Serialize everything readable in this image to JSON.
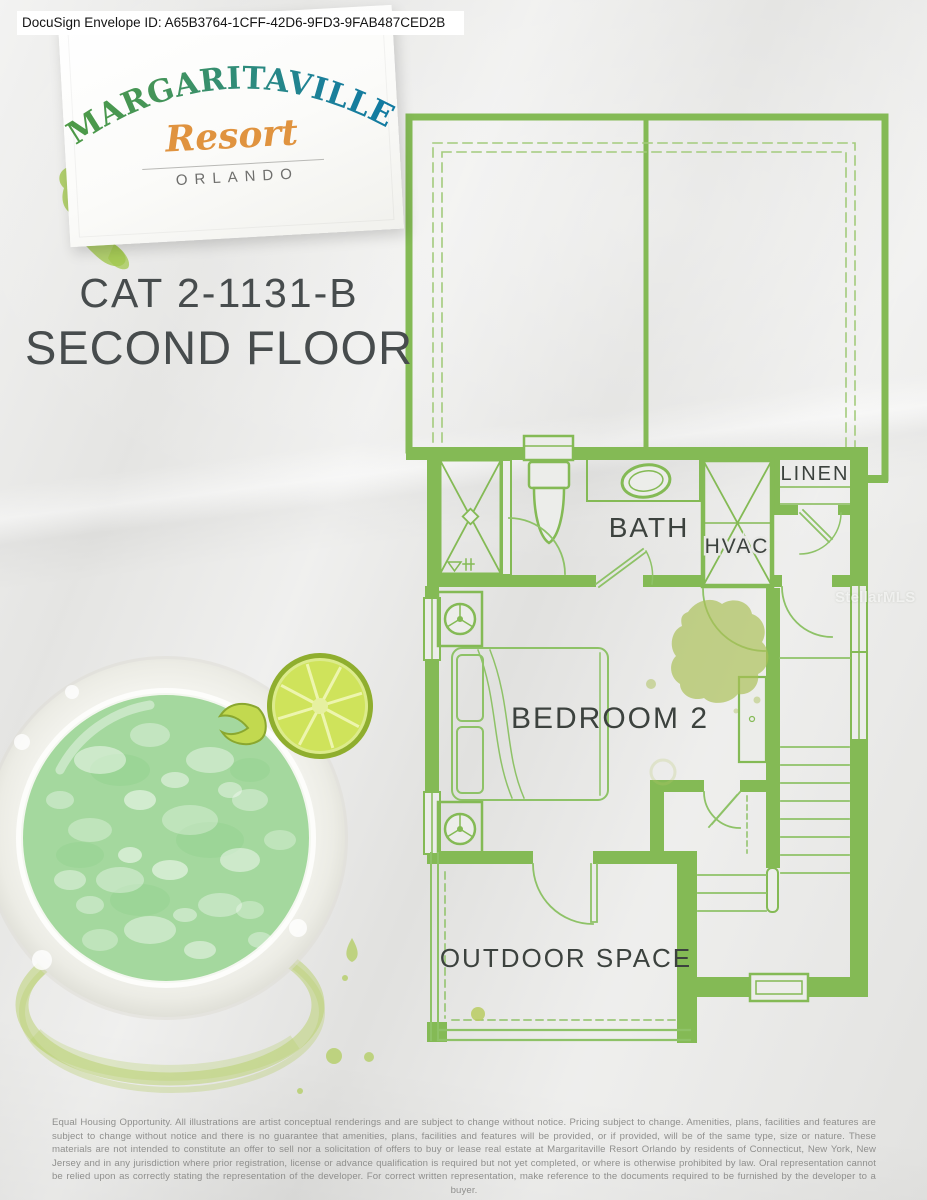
{
  "header": {
    "docusign_label": "DocuSign Envelope ID: A65B3764-1CFF-42D6-9FD3-9FAB487CED2B"
  },
  "logo": {
    "brand_display": "MARGARITAVILLE",
    "script": "Resort",
    "city": "ORLANDO"
  },
  "plan": {
    "unit_code": "CAT 2-1131-B",
    "floor_title": "SECOND FLOOR",
    "rooms": {
      "linen": "LINEN",
      "bath": "BATH",
      "hvac": "HVAC",
      "bedroom": "BEDROOM 2",
      "outdoor": "OUTDOOR SPACE"
    }
  },
  "watermark": "StellarMLS",
  "footer": {
    "disclaimer": "Equal Housing Opportunity. All illustrations are artist conceptual renderings and are subject to change without notice. Pricing subject to change. Amenities, plans, facilities and features are subject to change without notice and there is no guarantee that amenities, plans, facilities and features will be provided, or if provided, will be of the same type, size or nature. These materials are not intended to constitute an offer to sell nor a solicitation of offers to buy or lease real estate at Margaritaville Resort Orlando by residents of Connecticut, New York, New Jersey and in any jurisdiction where prior registration, license or advance qualification is required but not yet completed, or where is otherwise prohibited by law. Oral representation cannot be relied upon as correctly stating the representation of the developer. For correct written representation, make reference to the documents required to be furnished by the developer to a buyer."
  },
  "colors": {
    "plan_green": "#84ba55",
    "plan_line_green": "#8ec267",
    "splash_green": "#a9bf55",
    "logo_green": "#4e9b45",
    "logo_teal": "#10789f",
    "logo_orange": "#e0933f"
  }
}
